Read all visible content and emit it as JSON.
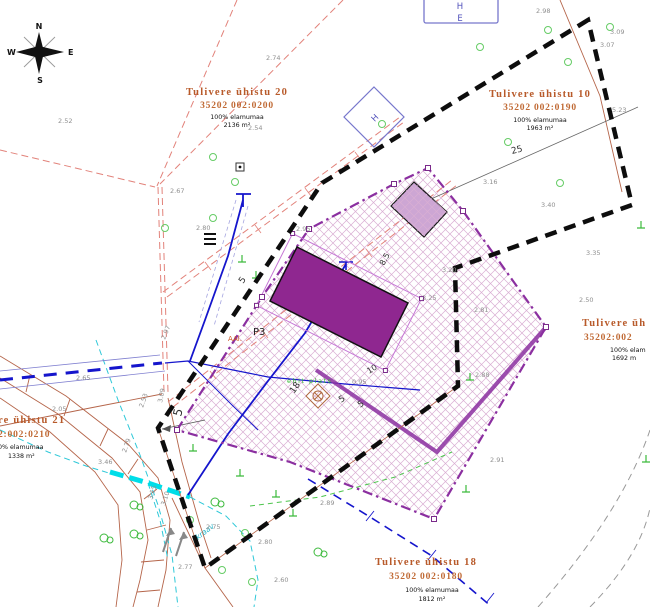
{
  "map": {
    "compass": {
      "n": "N",
      "e": "E",
      "s": "S",
      "w": "W"
    },
    "colors": {
      "cadastral_boundary": "#0d0d0d",
      "plan_boundary": "#8b2fa0",
      "building_fill": "#8f2790",
      "outbuilding_fill": "#cda6d4",
      "hatch": "#d9aed3",
      "road": "#b5654a",
      "power_line": "#e2827a",
      "water_line": "#1515cc",
      "ditch": "#2ec8d8",
      "ditch_highlight": "#00dde8",
      "vegetation": "#55cc55",
      "spot_height": "#8f8f8f",
      "parcel_label": "#b85a2a"
    },
    "parcels": [
      {
        "name": "Tulivere ühistu 20",
        "cadastral": "35202 002:0200",
        "usage": "100% elamumaa",
        "area": "2136 m²"
      },
      {
        "name": "Tulivere ühistu 10",
        "cadastral": "35202 002:0190",
        "usage": "100% elamumaa",
        "area": "1963 m²"
      },
      {
        "name": "Tulivere üh",
        "cadastral": "35202:002",
        "usage": "100% elam",
        "area": "1692 m"
      },
      {
        "name": "re ühistu 21",
        "cadastral": "2:002:0210",
        "usage": "0% elamumaa",
        "area": "1338 m²"
      },
      {
        "name": "Tulivere ühistu 18",
        "cadastral": "35202 002:0180",
        "usage": "100% elamumaa",
        "area": "1812 m²"
      }
    ],
    "annotations": {
      "p3": "P3",
      "ehit_plats": "ehit plats",
      "kraav": "kraav",
      "aal": "AAl.",
      "h_kiosk": "H",
      "he_h": "H",
      "he_e": "E"
    },
    "dims": [
      {
        "x": 512,
        "y": 154,
        "v": "25",
        "r": -14,
        "s": 9
      },
      {
        "x": 294,
        "y": 394,
        "v": "18",
        "r": -55,
        "s": 9
      },
      {
        "x": 369,
        "y": 374,
        "v": "10",
        "r": -32,
        "s": 8
      },
      {
        "x": 384,
        "y": 266,
        "v": "8.5",
        "r": -62,
        "s": 8
      },
      {
        "x": 243,
        "y": 284,
        "v": "5",
        "r": -55,
        "s": 9
      },
      {
        "x": 181,
        "y": 417,
        "v": "5",
        "r": -76,
        "s": 12
      },
      {
        "x": 341,
        "y": 403,
        "v": "5",
        "r": -33,
        "s": 9
      },
      {
        "x": 360,
        "y": 408,
        "v": "5",
        "r": -33,
        "s": 9
      }
    ],
    "spot_heights": [
      {
        "x": 536,
        "y": 13,
        "v": "2.98"
      },
      {
        "x": 610,
        "y": 34,
        "v": "3.09"
      },
      {
        "x": 600,
        "y": 47,
        "v": "3.07"
      },
      {
        "x": 266,
        "y": 60,
        "v": "2.74"
      },
      {
        "x": 248,
        "y": 130,
        "v": "2.54"
      },
      {
        "x": 170,
        "y": 193,
        "v": "2.67"
      },
      {
        "x": 196,
        "y": 230,
        "v": "2.80"
      },
      {
        "x": 296,
        "y": 231,
        "v": "2.95"
      },
      {
        "x": 612,
        "y": 112,
        "v": "5.23"
      },
      {
        "x": 483,
        "y": 184,
        "v": "3.16"
      },
      {
        "x": 541,
        "y": 207,
        "v": "3.40"
      },
      {
        "x": 586,
        "y": 255,
        "v": "3.35"
      },
      {
        "x": 442,
        "y": 272,
        "v": "3.20"
      },
      {
        "x": 422,
        "y": 300,
        "v": "3.25"
      },
      {
        "x": 474,
        "y": 312,
        "v": "2.81"
      },
      {
        "x": 579,
        "y": 302,
        "v": "2.50"
      },
      {
        "x": 475,
        "y": 377,
        "v": "2.88"
      },
      {
        "x": 490,
        "y": 462,
        "v": "2.91"
      },
      {
        "x": 320,
        "y": 505,
        "v": "2.89"
      },
      {
        "x": 258,
        "y": 544,
        "v": "2.80"
      },
      {
        "x": 274,
        "y": 582,
        "v": "2.60"
      },
      {
        "x": 178,
        "y": 569,
        "v": "2.77"
      },
      {
        "x": 206,
        "y": 529,
        "v": "2.75"
      },
      {
        "x": 98,
        "y": 464,
        "v": "3.46"
      },
      {
        "x": 76,
        "y": 380,
        "v": "2.65"
      },
      {
        "x": 52,
        "y": 411,
        "v": "2.05"
      },
      {
        "x": 352,
        "y": 384,
        "v": "0.95"
      },
      {
        "x": 58,
        "y": 123,
        "v": "2.52"
      },
      {
        "x": 165,
        "y": 340,
        "v": "2.97",
        "r": -68
      },
      {
        "x": 162,
        "y": 403,
        "v": "3.09",
        "r": -78
      },
      {
        "x": 143,
        "y": 408,
        "v": "2.53",
        "r": -70
      },
      {
        "x": 126,
        "y": 453,
        "v": "2.79",
        "r": -70
      },
      {
        "x": 152,
        "y": 500,
        "v": "3.15",
        "r": -72
      },
      {
        "x": 165,
        "y": 506,
        "v": "3.10",
        "r": -72
      }
    ],
    "symbols": {
      "compass_rose": "4-point-star",
      "tree": "double-circle",
      "conifer": "inverted-T",
      "transformer_kiosk": "H-diamond",
      "shed": "HE-box",
      "well": "circled-cross-diamond"
    }
  }
}
